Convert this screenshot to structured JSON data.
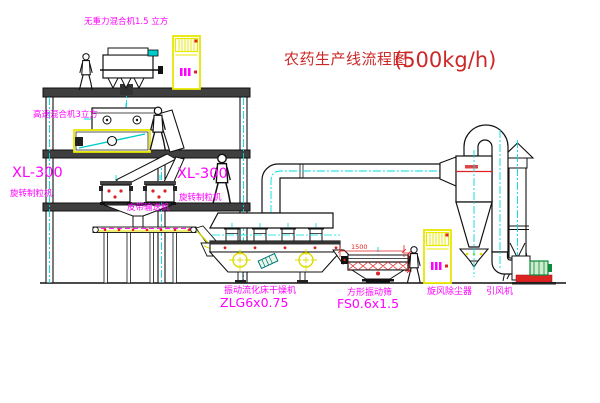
{
  "title": {
    "name": "农药生产线流程图",
    "capacity": "(500kg/h)"
  },
  "labels": {
    "gravity_mixer": "无重力混合机1.5 立方",
    "speed_mixer": "高速混合机3立方",
    "granulator_left_model": "XL-300",
    "granulator_left_name": "旋转制粒机",
    "granulator_right_model": "XL-300",
    "granulator_right_name": "旋转制粒机",
    "belt_conveyor": "皮带输送机",
    "dryer_name": "振动流化床干燥机",
    "dryer_model": "ZLG6x0.75",
    "sieve_name": "方形振动筛",
    "sieve_model": "FS0.6x1.5",
    "cyclone_name": "旋风除尘器",
    "fan_name": "引风机"
  },
  "dimensions": {
    "sieve_length": "1500"
  },
  "colors": {
    "label_magenta": "#ff00ff",
    "title_red": "#cc2828",
    "line_black": "#111111",
    "centerline_cyan": "#00dcdc",
    "equipment_yellow": "#e8e800",
    "red_mark": "#dd2222",
    "motor_green": "#0a8a3a",
    "slab_gray": "#3f3f3f"
  }
}
